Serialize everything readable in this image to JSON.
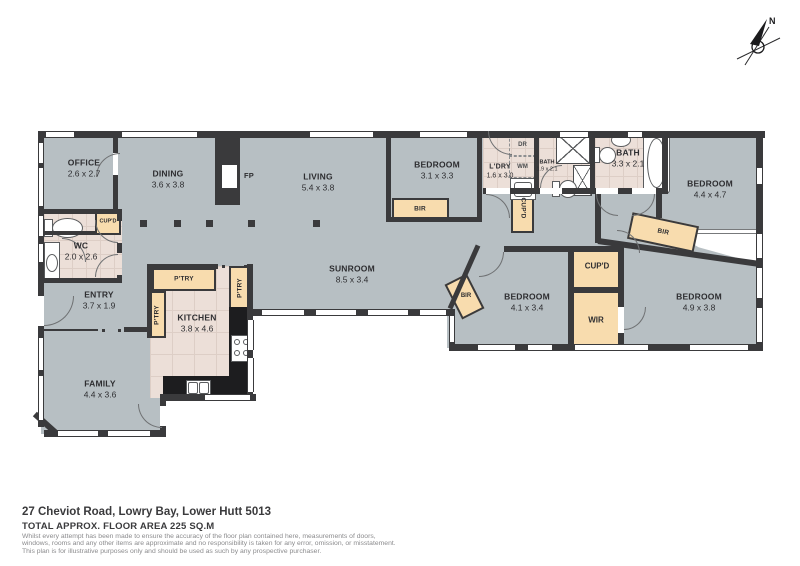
{
  "compass": {
    "north": "N"
  },
  "rooms": {
    "office": {
      "name": "OFFICE",
      "dims": "2.6 x 2.7"
    },
    "dining": {
      "name": "DINING",
      "dims": "3.6 x 3.8"
    },
    "living": {
      "name": "LIVING",
      "dims": "5.4 x 3.8"
    },
    "bedroom1": {
      "name": "BEDROOM",
      "dims": "3.1 x 3.3"
    },
    "laundry": {
      "name": "L'DRY",
      "dims": "1.6 x 3.0"
    },
    "bath_small": {
      "name": "BATH",
      "dims": "1.9 x 2.1"
    },
    "bath_main": {
      "name": "BATH",
      "dims": "3.3 x 2.1"
    },
    "bedroom2": {
      "name": "BEDROOM",
      "dims": "4.4 x 4.7"
    },
    "wc": {
      "name": "WC",
      "dims": "2.0 x 2.6"
    },
    "entry": {
      "name": "ENTRY",
      "dims": "3.7 x 1.9"
    },
    "kitchen": {
      "name": "KITCHEN",
      "dims": "3.8 x 4.6"
    },
    "family": {
      "name": "FAMILY",
      "dims": "4.4 x 3.6"
    },
    "sunroom": {
      "name": "SUNROOM",
      "dims": "8.5 x 3.4"
    },
    "bedroom3": {
      "name": "BEDROOM",
      "dims": "4.1 x 3.4"
    },
    "bedroom4": {
      "name": "BEDROOM",
      "dims": "4.9 x 3.8"
    }
  },
  "storage": {
    "cupboard": "CUP'D",
    "pantry": "P'TRY",
    "built_in_robe": "BIR",
    "walk_in_robe": "WIR"
  },
  "appliances": {
    "fireplace": "FP",
    "dryer": "DR",
    "washer": "WM"
  },
  "footer": {
    "address": "27 Cheviot Road, Lowry Bay, Lower Hutt 5013",
    "area": "TOTAL APPROX. FLOOR AREA 225 SQ.M",
    "disclaimer1": "Whilst every attempt has been made to ensure the accuracy of the floor plan contained here, measurements of doors,",
    "disclaimer2": "windows, rooms and any other items are approximate and no responsibility is taken for any error, omission, or misstatement.",
    "disclaimer3": "This plan is for illustrative purposes only and should be used as such by any prospective purchaser."
  },
  "colors": {
    "wall": "#3a3a3c",
    "carpet": "#b7bfc3",
    "tile": "#ecdfd8",
    "robe": "#f8dcae",
    "counter": "#1d1d1f"
  }
}
